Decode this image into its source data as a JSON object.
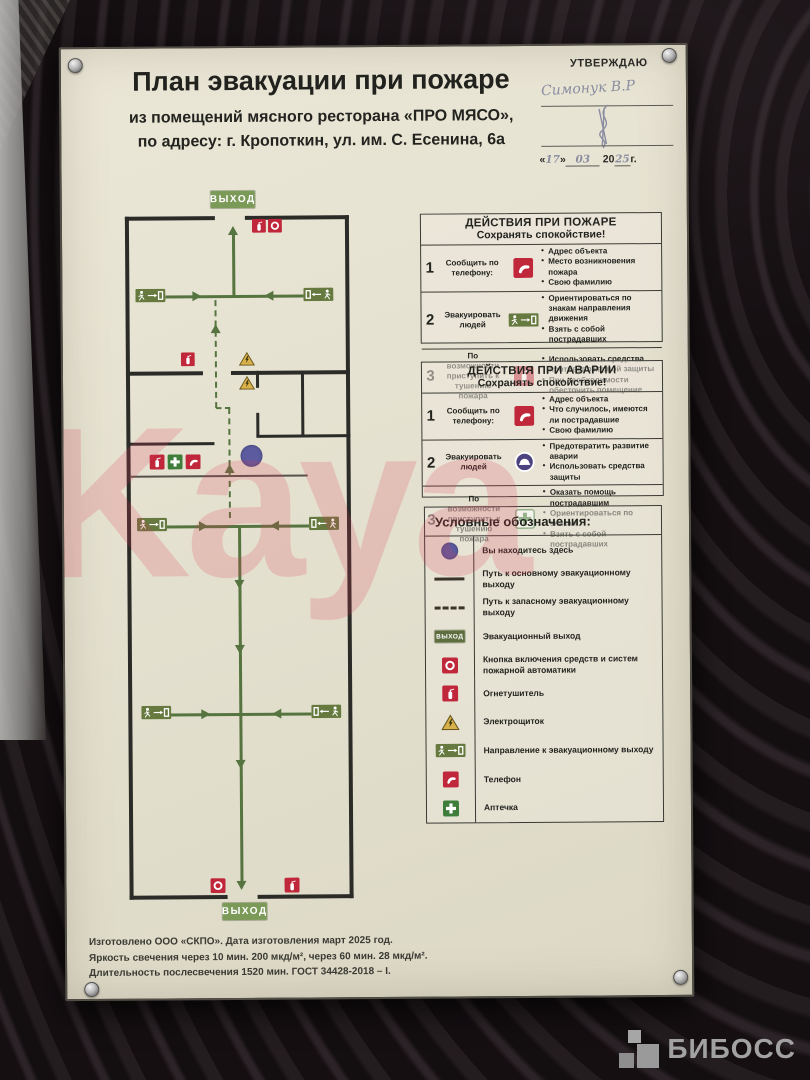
{
  "approval": {
    "label": "УТВЕРЖДАЮ",
    "signature": "Симонук В.Р",
    "day": "17",
    "month": "03",
    "year_prefix": "20",
    "year": "25",
    "year_suffix": "г.",
    "quote_open": "«",
    "quote_close": "»"
  },
  "header": {
    "title": "План эвакуации при пожаре",
    "subtitle_line1": "из помещений мясного ресторана «ПРО МЯСО»,",
    "subtitle_line2": "по адресу: г. Кропоткин, ул. им. С. Есенина, 6а"
  },
  "plan": {
    "exit_label": "ВЫХОД"
  },
  "fire_panel": {
    "title": "ДЕЙСТВИЯ ПРИ ПОЖАРЕ",
    "subtitle": "Сохранять спокойствие!",
    "rows": [
      {
        "num": "1",
        "label": "Сообщить по телефону:",
        "icon": "phone",
        "bullets": [
          "Адрес объекта",
          "Место возникновения пожара",
          "Свою фамилию"
        ]
      },
      {
        "num": "2",
        "label": "Эвакуировать людей",
        "icon": "exit-direction-sign",
        "bullets": [
          "Ориентироваться по знакам направления движения",
          "Взять с собой пострадавших"
        ]
      },
      {
        "num": "3",
        "label": "По возможности приступить к тушению пожара",
        "icon": "fire-extinguisher",
        "bullets": [
          "Использовать средства противопожарной защиты",
          "При необходимости обесточить помещение"
        ]
      }
    ]
  },
  "accident_panel": {
    "title": "ДЕЙСТВИЯ ПРИ АВАРИИ",
    "subtitle": "Сохранять спокойствие!",
    "rows": [
      {
        "num": "1",
        "label": "Сообщить по телефону:",
        "icon": "phone",
        "bullets": [
          "Адрес объекта",
          "Что случилось, имеются ли пострадавшие",
          "Свою фамилию"
        ]
      },
      {
        "num": "2",
        "label": "Эвакуировать людей",
        "icon": "protective-helmet",
        "bullets": [
          "Предотвратить развитие аварии",
          "Использовать средства защиты"
        ]
      },
      {
        "num": "3",
        "label": "По возможности приступить к тушению пожара",
        "icon": "first-aid-kit",
        "bullets": [
          "Оказать помощь пострадавшим",
          "Ориентироваться по знакам",
          "Взять с собой пострадавших"
        ]
      }
    ]
  },
  "legend": {
    "title": "Условные обозначения:",
    "items": [
      {
        "icon": "you-are-here-dot",
        "label": "Вы находитесь здесь"
      },
      {
        "icon": "solid-route-line",
        "label": "Путь к основному эвакуационному выходу"
      },
      {
        "icon": "dashed-route-line",
        "label": "Путь к запасному эвакуационному выходу"
      },
      {
        "icon": "exit-sign",
        "label": "Эвакуационный выход"
      },
      {
        "icon": "fire-alarm-button",
        "label": "Кнопка включения средств и систем пожарной автоматики"
      },
      {
        "icon": "fire-extinguisher",
        "label": "Огнетушитель"
      },
      {
        "icon": "electrical-panel",
        "label": "Электрощиток"
      },
      {
        "icon": "exit-direction-sign",
        "label": "Направление к эвакуационному выходу"
      },
      {
        "icon": "phone",
        "label": "Телефон"
      },
      {
        "icon": "first-aid-kit",
        "label": "Аптечка"
      }
    ]
  },
  "footer": {
    "line1": "Изготовлено ООО «СКПО». Дата изготовления март 2025 год.",
    "line2": "Яркость свечения через 10 мин. 200 мкд/м², через 60 мин. 28 мкд/м².",
    "line3": "Длительность послесвечения 1520 мин. ГОСТ 34428-2018 – I."
  },
  "watermarks": {
    "photo_text": "Kaya",
    "brand": "БИБОСС"
  },
  "colors": {
    "route_green": "#55743f",
    "sign_green": "#66793f",
    "icon_red": "#c0273a",
    "warning_yellow": "#d8b14a",
    "dot_blue": "#5c5b9f",
    "poster_cream": "#e6e2d1"
  }
}
